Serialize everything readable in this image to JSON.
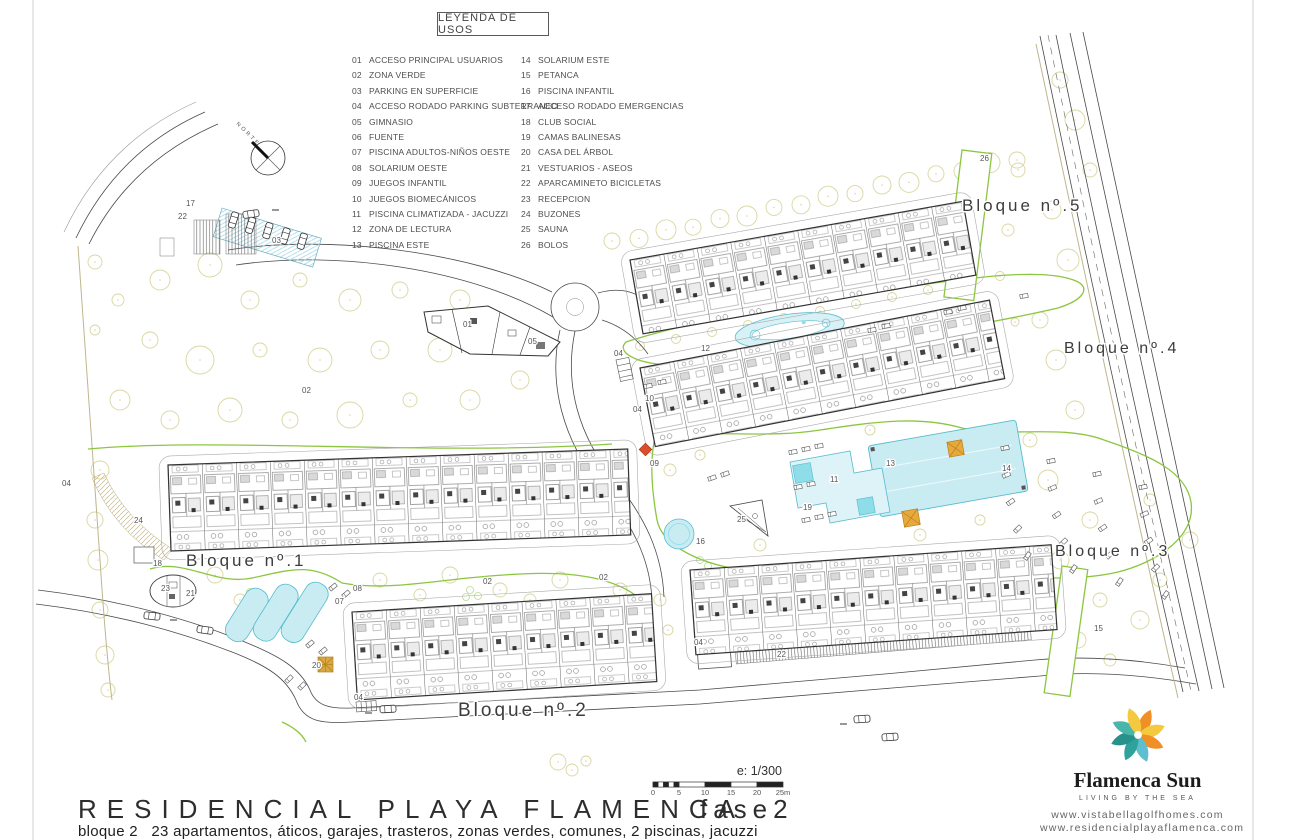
{
  "legend": {
    "title": "LEYENDA DE USOS",
    "items": [
      {
        "num": "01",
        "label": "ACCESO PRINCIPAL USUARIOS"
      },
      {
        "num": "02",
        "label": "ZONA VERDE"
      },
      {
        "num": "03",
        "label": "PARKING EN SUPERFICIE"
      },
      {
        "num": "04",
        "label": "ACCESO RODADO PARKING SUBTERRANEO"
      },
      {
        "num": "05",
        "label": "GIMNASIO"
      },
      {
        "num": "06",
        "label": "FUENTE"
      },
      {
        "num": "07",
        "label": "PISCINA ADULTOS-NIÑOS OESTE"
      },
      {
        "num": "08",
        "label": "SOLARIUM OESTE"
      },
      {
        "num": "09",
        "label": "JUEGOS INFANTIL"
      },
      {
        "num": "10",
        "label": "JUEGOS BIOMECÁNICOS"
      },
      {
        "num": "11",
        "label": "PISCINA CLIMATIZADA - JACUZZI"
      },
      {
        "num": "12",
        "label": "ZONA DE LECTURA"
      },
      {
        "num": "13",
        "label": "PISCINA ESTE"
      },
      {
        "num": "14",
        "label": "SOLARIUM ESTE"
      },
      {
        "num": "15",
        "label": "PETANCA"
      },
      {
        "num": "16",
        "label": "PISCINA INFANTIL"
      },
      {
        "num": "17",
        "label": "ACCESO RODADO EMERGENCIAS"
      },
      {
        "num": "18",
        "label": "CLUB SOCIAL"
      },
      {
        "num": "19",
        "label": "CAMAS BALINESAS"
      },
      {
        "num": "20",
        "label": "CASA DEL ÁRBOL"
      },
      {
        "num": "21",
        "label": "VESTUARIOS - ASEOS"
      },
      {
        "num": "22",
        "label": "APARCAMINETO BICICLETAS"
      },
      {
        "num": "23",
        "label": "RECEPCION"
      },
      {
        "num": "24",
        "label": "BUZONES"
      },
      {
        "num": "25",
        "label": "SAUNA"
      },
      {
        "num": "26",
        "label": "BOLOS"
      }
    ]
  },
  "plan": {
    "compass_label": "NORTE",
    "block_labels": [
      {
        "text": "Bloque nº.1",
        "x": 186,
        "y": 566,
        "size": 17
      },
      {
        "text": "Bloque nº.2",
        "x": 458,
        "y": 716,
        "size": 19
      },
      {
        "text": "Bloque nº.3",
        "x": 1055,
        "y": 556,
        "size": 16
      },
      {
        "text": "Bloque nº.4",
        "x": 1064,
        "y": 353,
        "size": 16
      },
      {
        "text": "Bloque nº.5",
        "x": 962,
        "y": 211,
        "size": 17
      }
    ],
    "annotations": [
      {
        "text": "17",
        "x": 186,
        "y": 206
      },
      {
        "text": "22",
        "x": 178,
        "y": 219
      },
      {
        "text": "03",
        "x": 272,
        "y": 243
      },
      {
        "text": "02",
        "x": 302,
        "y": 393
      },
      {
        "text": "02",
        "x": 483,
        "y": 584
      },
      {
        "text": "02",
        "x": 599,
        "y": 580
      },
      {
        "text": "04",
        "x": 62,
        "y": 486
      },
      {
        "text": "24",
        "x": 134,
        "y": 523
      },
      {
        "text": "18",
        "x": 153,
        "y": 566
      },
      {
        "text": "23",
        "x": 161,
        "y": 591
      },
      {
        "text": "21",
        "x": 186,
        "y": 596
      },
      {
        "text": "08",
        "x": 353,
        "y": 591
      },
      {
        "text": "07",
        "x": 335,
        "y": 604
      },
      {
        "text": "20",
        "x": 312,
        "y": 668
      },
      {
        "text": "04",
        "x": 354,
        "y": 700
      },
      {
        "text": "01",
        "x": 463,
        "y": 327
      },
      {
        "text": "05",
        "x": 528,
        "y": 344
      },
      {
        "text": "04",
        "x": 614,
        "y": 356
      },
      {
        "text": "10",
        "x": 645,
        "y": 401
      },
      {
        "text": "04",
        "x": 633,
        "y": 412
      },
      {
        "text": "09",
        "x": 650,
        "y": 466
      },
      {
        "text": "12",
        "x": 701,
        "y": 351
      },
      {
        "text": "16",
        "x": 696,
        "y": 544
      },
      {
        "text": "25",
        "x": 737,
        "y": 522
      },
      {
        "text": "19",
        "x": 803,
        "y": 510
      },
      {
        "text": "11",
        "x": 830,
        "y": 482
      },
      {
        "text": "13",
        "x": 886,
        "y": 466
      },
      {
        "text": "14",
        "x": 1002,
        "y": 471
      },
      {
        "text": "22",
        "x": 777,
        "y": 657
      },
      {
        "text": "04",
        "x": 694,
        "y": 645
      },
      {
        "text": "15",
        "x": 1094,
        "y": 631
      },
      {
        "text": "26",
        "x": 980,
        "y": 161
      }
    ]
  },
  "footer": {
    "title": "RESIDENCIAL PLAYA FLAMENCA",
    "phase": "fase2",
    "subtitle": "bloque 2   23 apartamentos, áticos, garajes, trasteros, zonas verdes, comunes, 2 piscinas, jacuzzi",
    "scale_label": "e: 1/300",
    "scale_ticks": [
      "0",
      "5",
      "10",
      "15",
      "20",
      "25m"
    ]
  },
  "brand": {
    "name": "Flamenca Sun",
    "tagline": "LIVING BY THE SEA",
    "urls": [
      "www.vistabellagolfhomes.com",
      "www.residencialplayaflamenca.com"
    ]
  },
  "colors": {
    "line": "#4a4a4a",
    "green": "#8cc63f",
    "tree": "#d9d79f",
    "pool_fill": "#c9ecf3",
    "pool_stroke": "#54bccd",
    "orange": "#e8a93c",
    "red": "#d8502a",
    "tan": "#bfb68c"
  }
}
